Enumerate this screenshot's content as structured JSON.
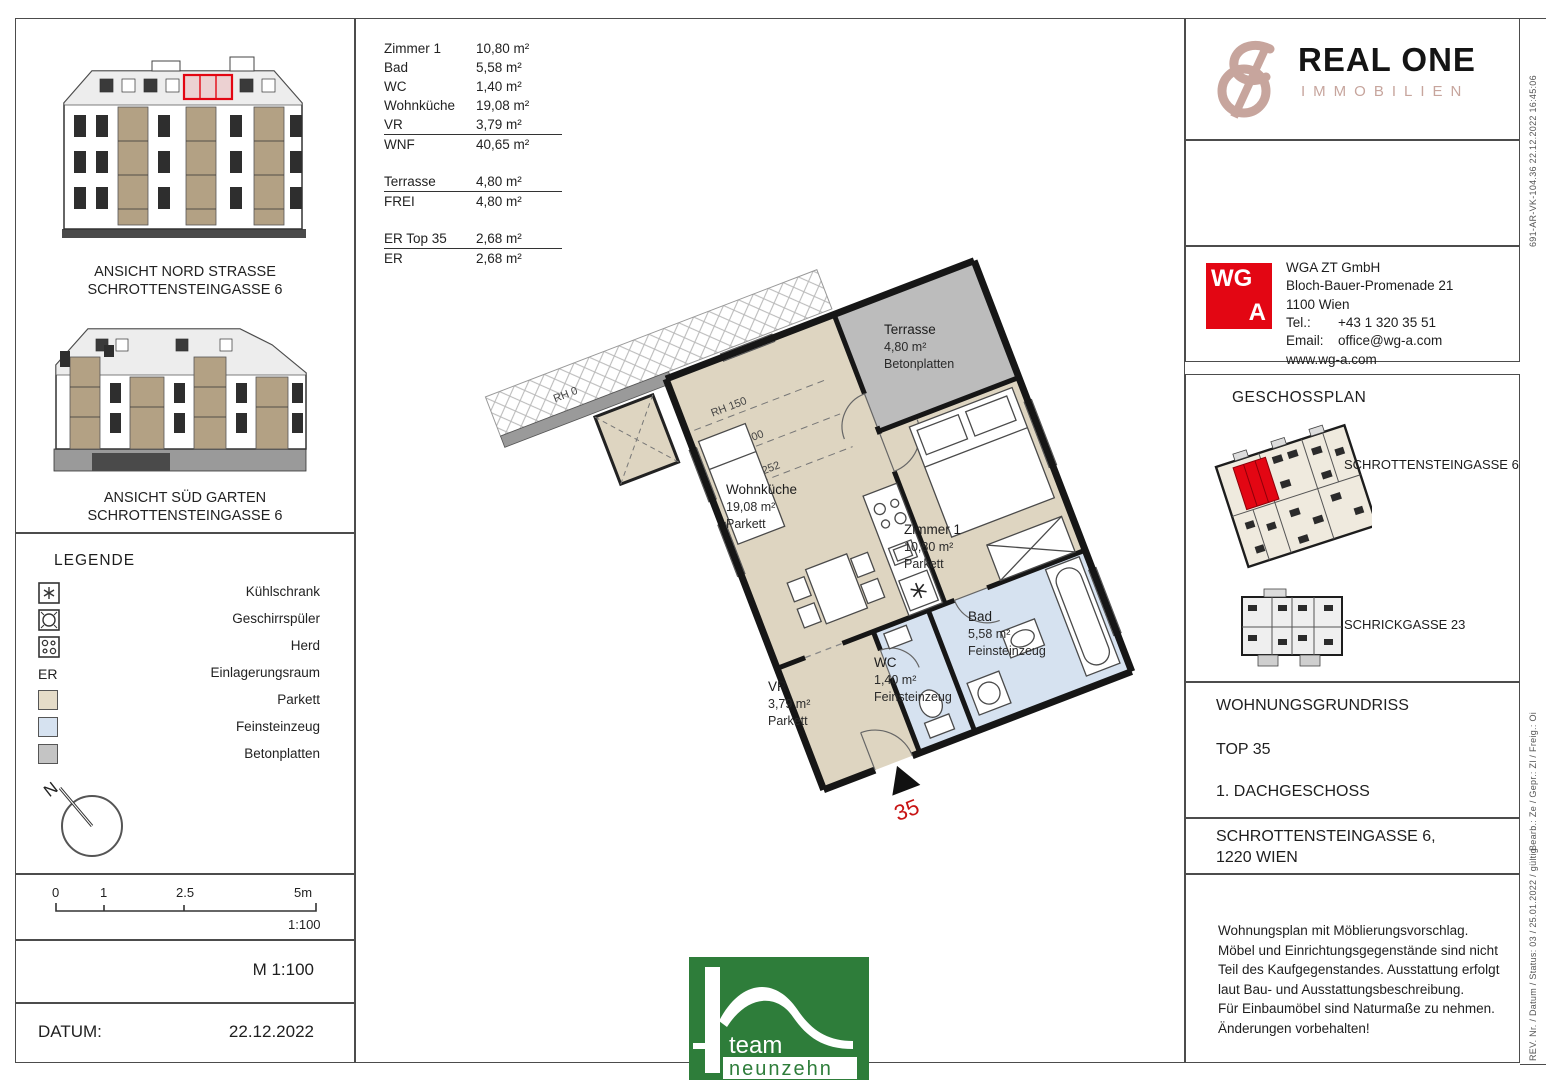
{
  "colors": {
    "accent_red": "#e30613",
    "parkett": "#ded5c1",
    "feinsteinzeug": "#d6e2f0",
    "betonplatten": "#bcbcbc",
    "team_green": "#2e7d3a",
    "brand_rose": "#c7a59d"
  },
  "area_table": {
    "rows": [
      {
        "label": "Zimmer 1",
        "value": "10,80 m²"
      },
      {
        "label": "Bad",
        "value": "5,58 m²"
      },
      {
        "label": "WC",
        "value": "1,40 m²"
      },
      {
        "label": "Wohnküche",
        "value": "19,08 m²"
      },
      {
        "label": "VR",
        "value": "3,79 m²"
      },
      {
        "label": "WNF",
        "value": "40,65 m²"
      },
      {
        "label": "Terrasse",
        "value": "4,80 m²"
      },
      {
        "label": "FREI",
        "value": "4,80 m²"
      },
      {
        "label": "ER Top 35",
        "value": "2,68 m²"
      },
      {
        "label": "ER",
        "value": "2,68 m²"
      }
    ]
  },
  "elevations": [
    {
      "line1": "ANSICHT NORD STRASSE",
      "line2": "SCHROTTENSTEINGASSE 6"
    },
    {
      "line1": "ANSICHT SÜD GARTEN",
      "line2": "SCHROTTENSTEINGASSE 6"
    }
  ],
  "legend": {
    "title": "LEGENDE",
    "items": [
      {
        "label": "Kühlschrank"
      },
      {
        "label": "Geschirrspüler"
      },
      {
        "label": "Herd"
      },
      {
        "key": "ER",
        "label": "Einlagerungsraum"
      },
      {
        "label": "Parkett"
      },
      {
        "label": "Feinsteinzeug"
      },
      {
        "label": "Betonplatten"
      }
    ]
  },
  "north": {
    "label": "N"
  },
  "scalebar": {
    "ticks": [
      "0",
      "1",
      "2.5",
      "5m"
    ],
    "ratio": "1:100"
  },
  "scale_text": "M 1:100",
  "datum": {
    "label": "DATUM:",
    "value": "22.12.2022"
  },
  "floorplan": {
    "unit_number": "35",
    "rh_labels": [
      "RH 0",
      "RH 150",
      "RH 200",
      "RH 252"
    ],
    "rooms": [
      {
        "name": "Terrasse",
        "area": "4,80 m²",
        "finish": "Betonplatten"
      },
      {
        "name": "Wohnküche",
        "area": "19,08 m²",
        "finish": "Parkett"
      },
      {
        "name": "Zimmer 1",
        "area": "10,80 m²",
        "finish": "Parkett"
      },
      {
        "name": "Bad",
        "area": "5,58 m²",
        "finish": "Feinsteinzeug"
      },
      {
        "name": "WC",
        "area": "1,40 m²",
        "finish": "Feinsteinzeug"
      },
      {
        "name": "VR",
        "area": "3,79 m²",
        "finish": "Parkett"
      }
    ]
  },
  "brand": {
    "name": "REAL ONE",
    "subtitle": "IMMOBILIEN"
  },
  "architect": {
    "logo_top": "WG",
    "logo_bottom": "A",
    "name": "WGA ZT GmbH",
    "address": "Bloch-Bauer-Promenade 21",
    "city": "1100 Wien",
    "tel_label": "Tel.:",
    "tel": "+43 1 320 35 51",
    "email_label": "Email:",
    "email": "office@wg-a.com",
    "web": "www.wg-a.com"
  },
  "geschossplan": {
    "title": "GESCHOSSPLAN",
    "plan1_label": "SCHROTTENSTEINGASSE 6",
    "plan2_label": "SCHRICKGASSE 23"
  },
  "titleblock": {
    "doc_type": "WOHNUNGSGRUNDRISS",
    "unit": "TOP 35",
    "floor": "1. DACHGESCHOSS",
    "address_line1": "SCHROTTENSTEINGASSE 6,",
    "address_line2": "1220 WIEN"
  },
  "disclaimer": "Wohnungsplan mit Möblierungsvorschlag.\nMöbel und Einrichtungsgegenstände sind nicht\nTeil des Kaufgegenstandes. Ausstattung erfolgt\nlaut Bau- und Ausstattungsbeschreibung.\nFür Einbaumöbel sind Naturmaße zu nehmen.\nÄnderungen vorbehalten!",
  "plot_info": {
    "stamp": "691-AR-VK-104.36    22.12.2022 16:45:06",
    "bearb": "Bearb.: Ze / Gepr.: Zl / Freig.: Oi",
    "rev": "REV. Nr. / Datum / Status: 03 / 25.01.2022 / gültig"
  },
  "team_logo": {
    "line1": "team",
    "line2": "neunzehn"
  }
}
